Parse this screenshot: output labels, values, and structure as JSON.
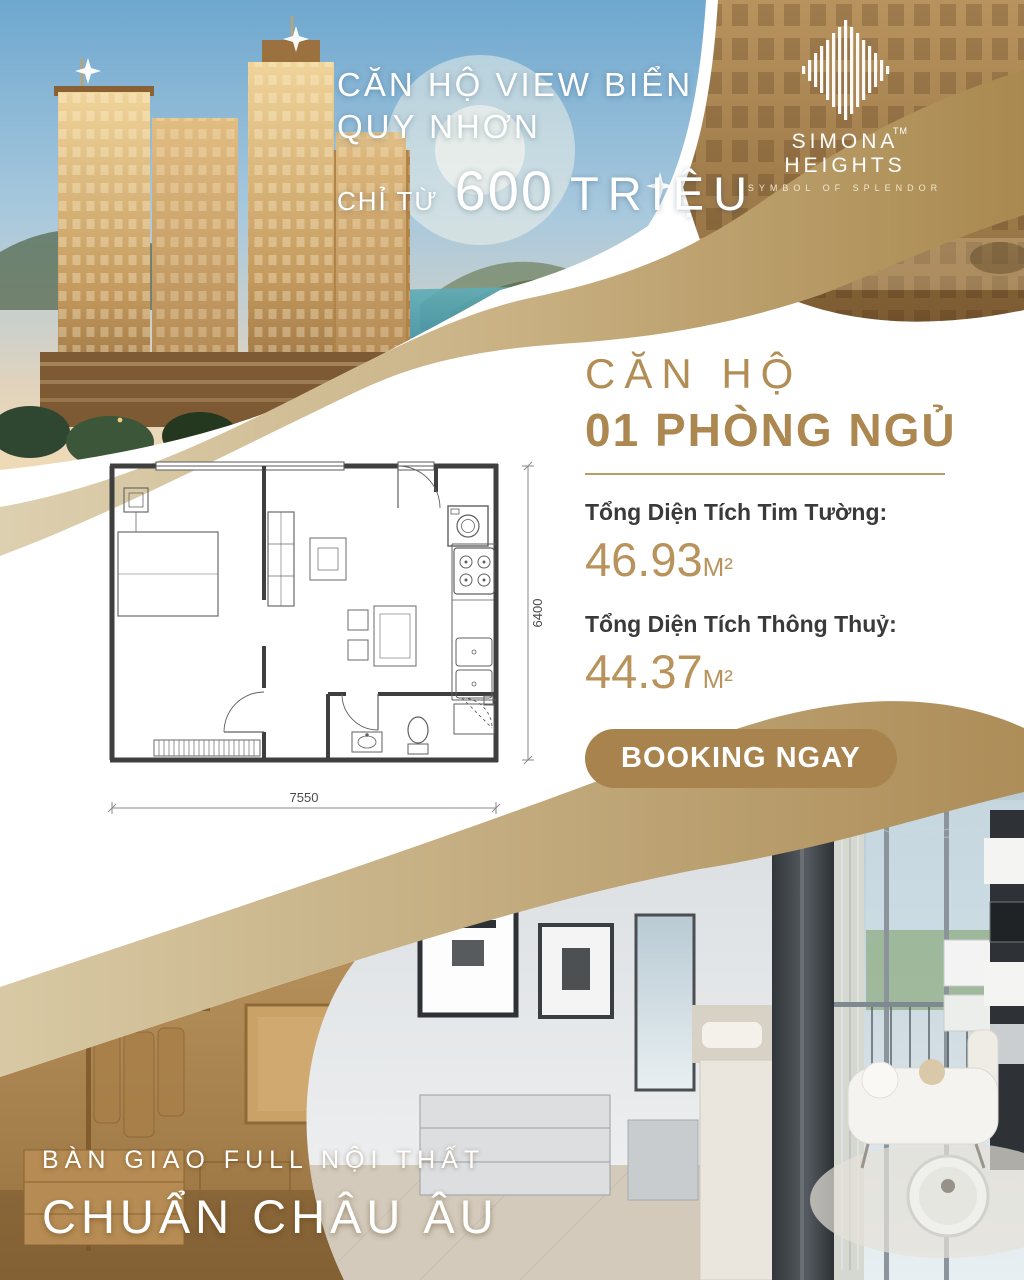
{
  "brand": {
    "name": "SIMONA HEIGHTS",
    "tagline": "SYMBOL OF SPLENDOR",
    "trademark": "TM"
  },
  "hero": {
    "headline_line1": "CĂN HỘ VIEW BIỂN",
    "headline_line2": "QUY NHƠN",
    "price_prefix": "CHỈ TỪ",
    "price_value": "600",
    "price_unit": "TRIỆU"
  },
  "unit": {
    "title_line1": "CĂN HỘ",
    "title_line2": "01 PHÒNG NGỦ",
    "gross_area_label": "Tổng Diện Tích Tim Tường:",
    "gross_area_value": "46.93",
    "net_area_label": "Tổng Diện Tích Thông Thuỷ:",
    "net_area_value": "44.37",
    "area_unit": "M²",
    "booking_label": "BOOKING NGAY"
  },
  "floor_plan": {
    "width_dim": "7550",
    "height_dim": "6400"
  },
  "footer": {
    "line1": "BÀN GIAO FULL NỘI THẤT",
    "line2": "CHUẨN CHÂU ÂU"
  },
  "colors": {
    "brand_gold": "#b28d55",
    "button_gold": "#a8834e",
    "ribbon_gold_dark": "#a9894f",
    "ribbon_gold_light": "#decfae",
    "text_dark": "#3a3a3a",
    "value_gold": "#b8935c"
  }
}
